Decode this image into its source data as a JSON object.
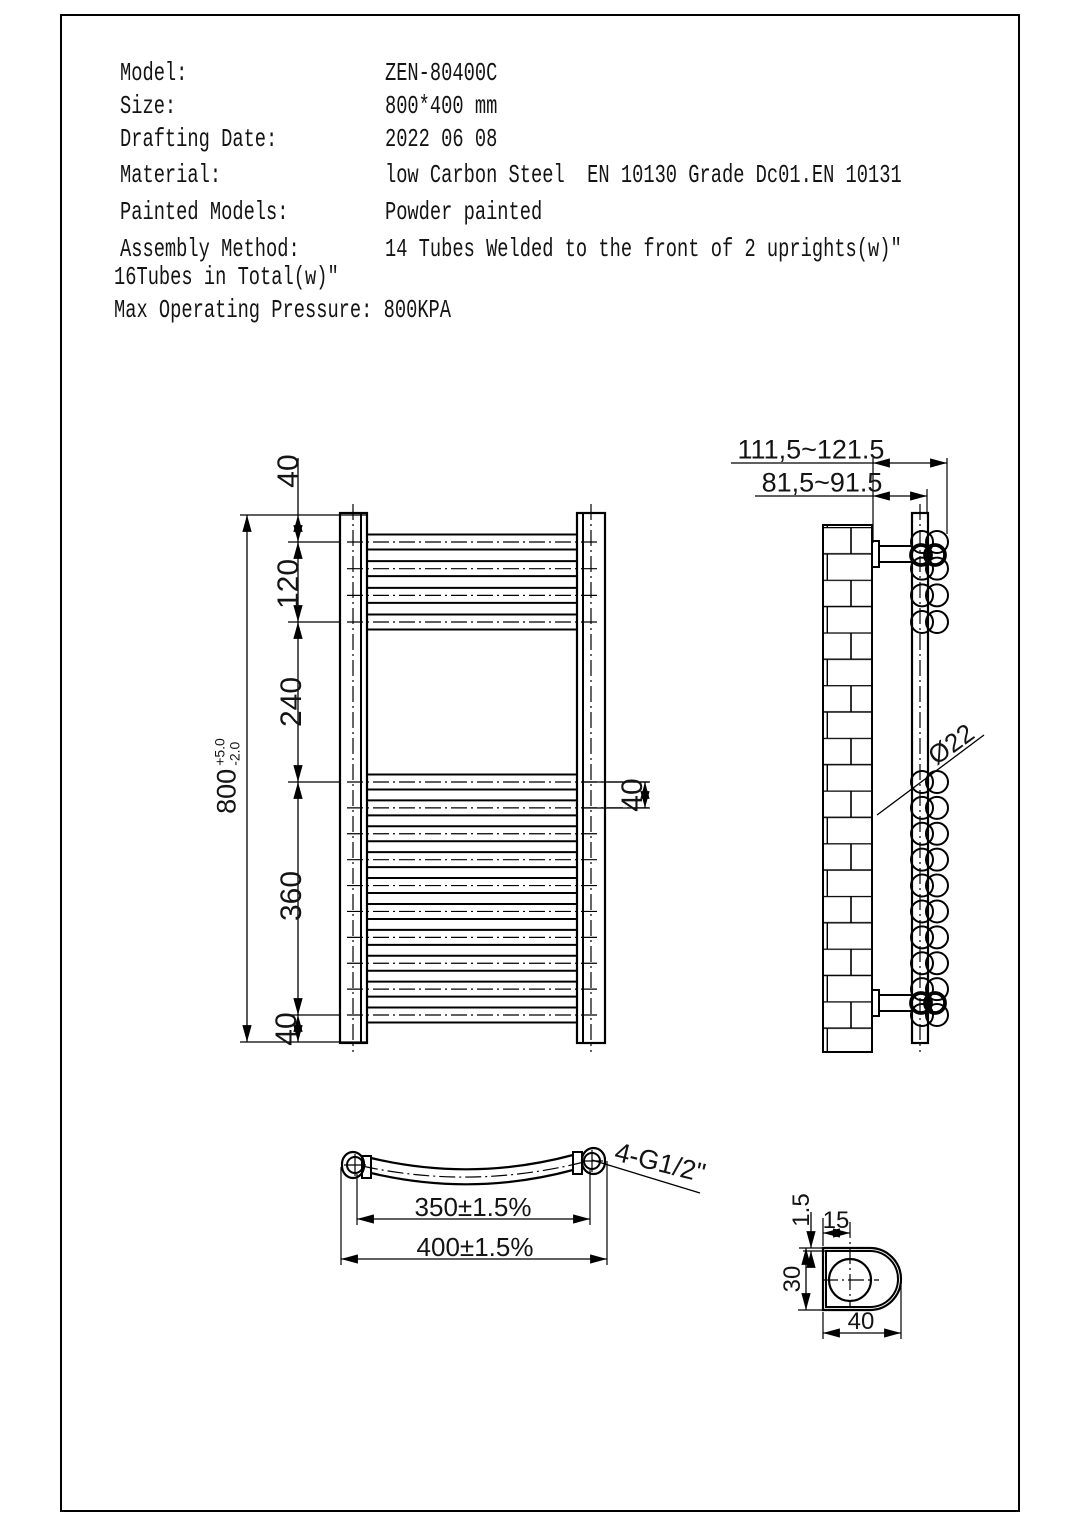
{
  "header": {
    "rows": [
      {
        "label": "Model:",
        "value": "ZEN-80400C"
      },
      {
        "label": "Size:",
        "value": "800*400 mm"
      },
      {
        "label": "Drafting Date:",
        "value": "2022 06 08"
      },
      {
        "label": "Material:",
        "value": "low Carbon Steel  EN 10130 Grade Dc01.EN 10131"
      },
      {
        "label": "Painted Models:",
        "value": "Powder painted"
      },
      {
        "label": "Assembly Method:",
        "value": "14 Tubes Welded to the front of 2 uprights(w)″"
      }
    ],
    "note_line1": "16Tubes in Total(w)″",
    "note_line2": "Max Operating Pressure: 800KPA"
  },
  "front_view": {
    "dims": {
      "top_offset": "40",
      "top_group": "120",
      "middle_gap": "240",
      "bottom_group": "360",
      "bottom_offset": "40",
      "overall": "800",
      "tol_plus": "+5.0",
      "tol_minus": "-2.0",
      "tube_pitch": "40"
    }
  },
  "side_view": {
    "dims": {
      "wall_to_tube_front": "111,5~121.5",
      "wall_to_upright": "81,5~91.5",
      "tube_diameter": "Ø22"
    }
  },
  "plan_view": {
    "dims": {
      "hole_centers": "350±1.5%",
      "overall_width": "400±1.5%",
      "thread": "4-G1/2\""
    }
  },
  "detail_view": {
    "dims": {
      "wall_thickness": "1.5",
      "tube_offset": "15",
      "profile_height": "30",
      "profile_width": "40"
    }
  }
}
